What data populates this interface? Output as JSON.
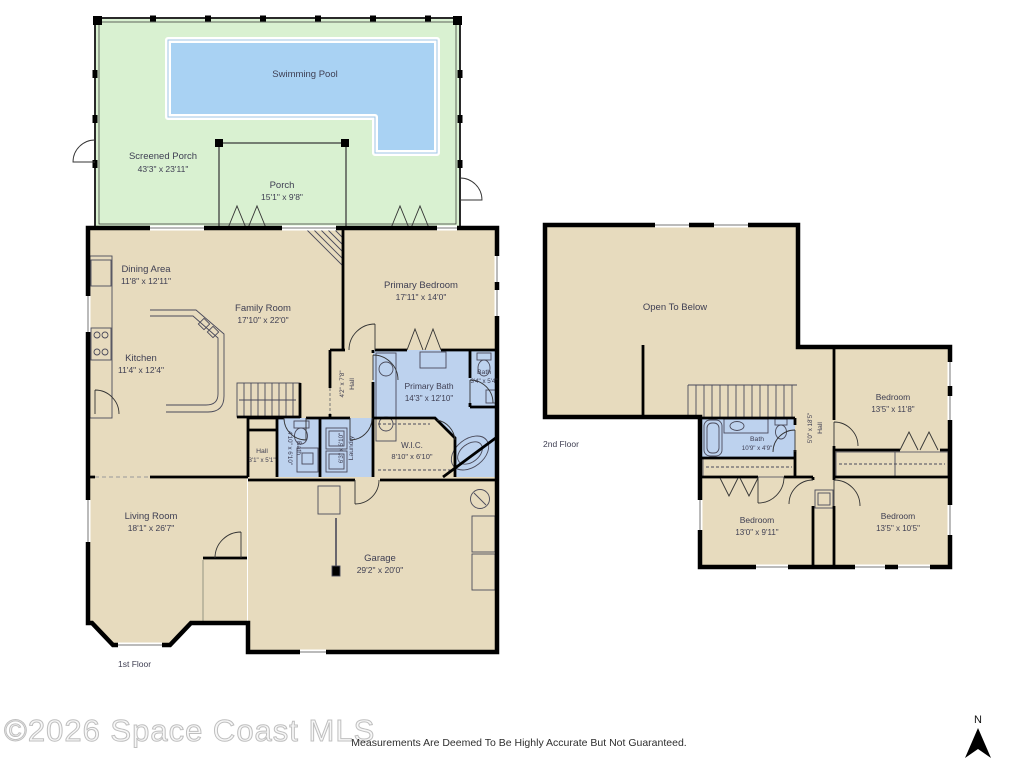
{
  "plan": {
    "watermark": "©2026 Space Coast MLS",
    "disclaimer": "Measurements Are Deemed To Be Highly Accurate But Not Guaranteed.",
    "compass": "N"
  },
  "colors": {
    "room_fill": "#e7dbbe",
    "wet_fill": "#bdd2ee",
    "porch_fill": "#d9f1d1",
    "pool_fill": "#a9d2f3",
    "wall": "#000000"
  },
  "floor1": {
    "floor_label": "1st Floor",
    "rooms": {
      "swimming_pool": {
        "name": "Swimming Pool",
        "dims": ""
      },
      "screened_porch": {
        "name": "Screened Porch",
        "dims": "43'3\" x 23'11\""
      },
      "porch": {
        "name": "Porch",
        "dims": "15'1\" x 9'8\""
      },
      "dining_area": {
        "name": "Dining Area",
        "dims": "11'8\" x 12'11\""
      },
      "family_room": {
        "name": "Family Room",
        "dims": "17'10\" x 22'0\""
      },
      "primary_bedroom": {
        "name": "Primary Bedroom",
        "dims": "17'11\" x 14'0\""
      },
      "kitchen": {
        "name": "Kitchen",
        "dims": "11'4\" x 12'4\""
      },
      "primary_bath": {
        "name": "Primary Bath",
        "dims": "14'3\" x 12'10\""
      },
      "toilet_bath": {
        "name": "Bath",
        "dims": "3'4\" x 5'4\""
      },
      "hall_upper": {
        "name": "Hall",
        "dims": "4'2\" x 7'8\""
      },
      "wic": {
        "name": "W.I.C.",
        "dims": "8'10\" x 6'10\""
      },
      "laundry": {
        "name": "Laundry",
        "dims": "6'3\" x 6'10\""
      },
      "bath": {
        "name": "Bath",
        "dims": "4'10\" x 6'10\""
      },
      "hall_small": {
        "name": "Hall",
        "dims": "3'1\" x 5'1\""
      },
      "living_room": {
        "name": "Living Room",
        "dims": "18'1\" x 26'7\""
      },
      "garage": {
        "name": "Garage",
        "dims": "29'2\" x 20'0\""
      }
    }
  },
  "floor2": {
    "floor_label": "2nd Floor",
    "rooms": {
      "open_to_below": {
        "name": "Open To Below",
        "dims": ""
      },
      "bath": {
        "name": "Bath",
        "dims": "10'9\" x 4'9\""
      },
      "hall": {
        "name": "Hall",
        "dims": "5'0\" x 18'5\""
      },
      "bedroom_right": {
        "name": "Bedroom",
        "dims": "13'5\" x 11'8\""
      },
      "bedroom_bottom_left": {
        "name": "Bedroom",
        "dims": "13'0\" x 9'11\""
      },
      "bedroom_bottom_right": {
        "name": "Bedroom",
        "dims": "13'5\" x 10'5\""
      }
    }
  }
}
